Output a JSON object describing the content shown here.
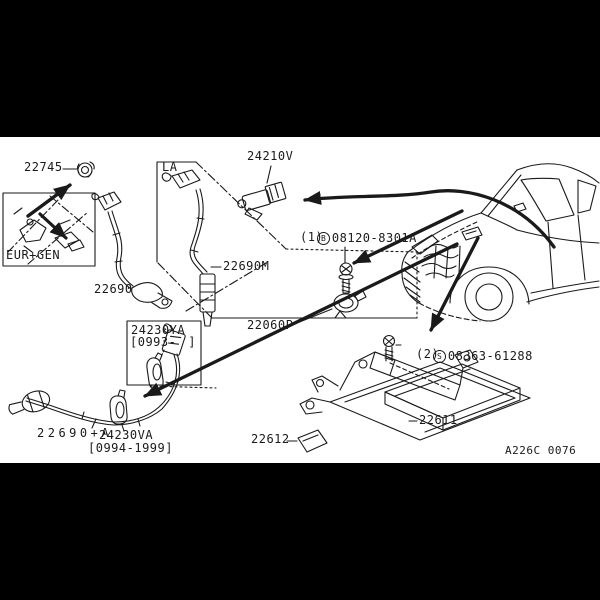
{
  "page": {
    "drawing_code": "A226C 0076"
  },
  "insets": {
    "eur_gen_label": "EUR+GEN",
    "la_label": "LA",
    "ya_box": {
      "title": "24230YA",
      "range_open": "[0993-",
      "range_close": "]"
    }
  },
  "labels": {
    "grommet": "22745",
    "front_sensor": "22690",
    "la_sensor": "22690M",
    "sub_harness": "24210V",
    "clamp": "22060P",
    "rear_sensor": "22690+A",
    "rear_clip": "24230VA",
    "rear_clip_range": "[0994-1999]",
    "ecu_bracket": "22611",
    "ecu_clip": "22612"
  },
  "hardware": {
    "bolt": {
      "symbol": "B",
      "number": "08120-8301A",
      "qty": "(1)"
    },
    "screw": {
      "symbol": "S",
      "number": "08363-61288",
      "qty": "(2)"
    }
  },
  "colors": {
    "ink": "#1a1a1a",
    "paper": "#ffffff",
    "letterbox": "#000000"
  }
}
